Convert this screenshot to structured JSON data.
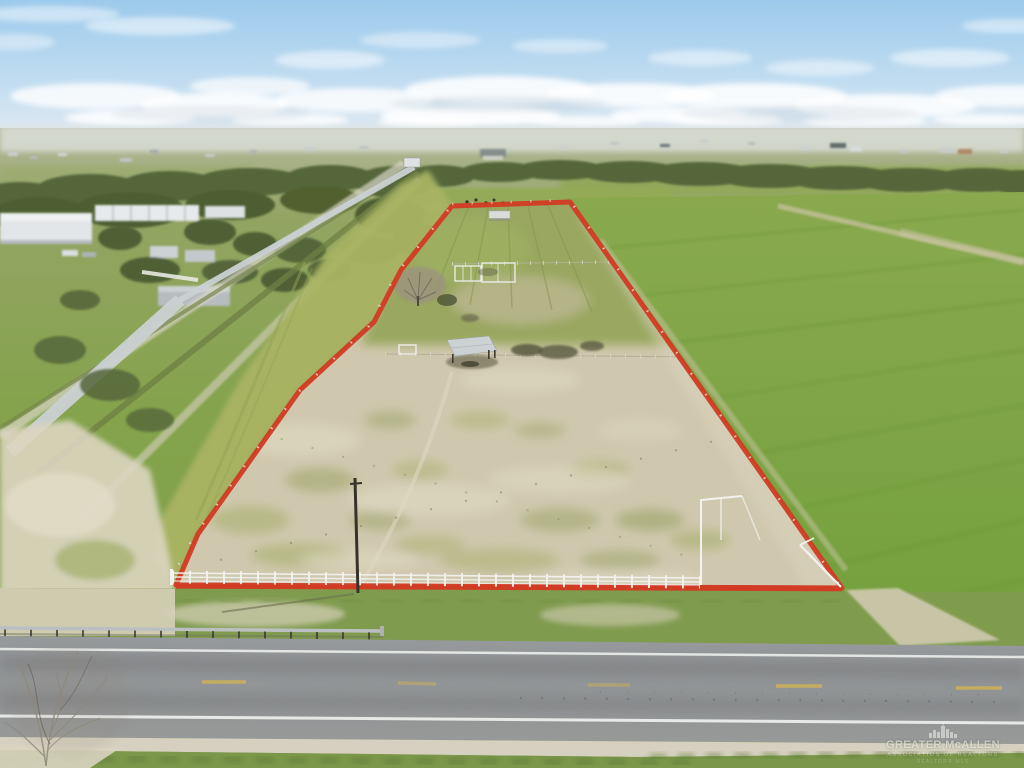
{
  "image": {
    "type": "aerial-drone-real-estate-photo",
    "subject": "Vacant fenced land parcel outlined in red along a rural highway, irrigation canal on the left, green farm fields around",
    "width": 1024,
    "height": 768
  },
  "watermark": {
    "title": "GREATER McALLEN",
    "subtitle": "ASSOCIATION OF REALTORS",
    "tagline": "REALTOR® MLS",
    "icon": "city-skyline-icon"
  },
  "boundary": {
    "label": "property-boundary-outline",
    "points": "452,206 570,202 842,588 176,585 198,534 300,390 374,322 401,270"
  },
  "colors": {
    "boundary_red": "#d23b24",
    "sky_top": "#9ccaec",
    "sky_mid": "#c2ddf1",
    "sky_horizon": "#e9eef2",
    "cloud_white": "#ffffff",
    "field_green_far": "#8aa94f",
    "field_green_near": "#73a03c",
    "strip_green": "#a9b463",
    "parcel_dirt": "#d0c8ae",
    "canal_water": "#cad1d3",
    "road_asphalt": "#8e9193",
    "road_line_white": "#eceeec",
    "road_line_yellow": "#d2b255",
    "fence_white": "#f2f3ef",
    "guardrail_gray": "#bcbfc1",
    "tree_dark": "#55663a"
  }
}
